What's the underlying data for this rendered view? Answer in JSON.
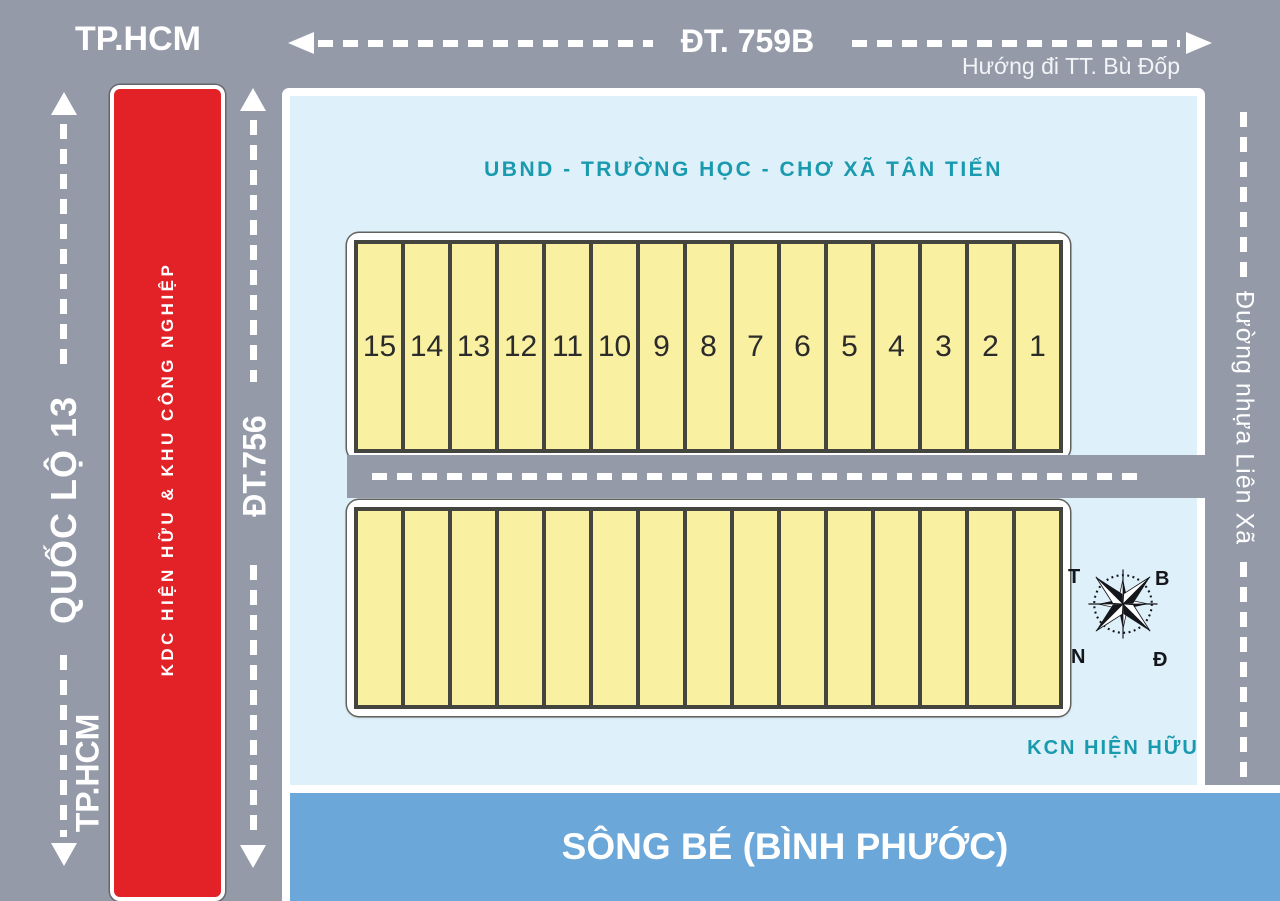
{
  "colors": {
    "road_gray": "#949aa8",
    "panel_blue": "#def0f9",
    "teal": "#1a9aae",
    "plot_yellow": "#f9f1a1",
    "plot_border": "#45453f",
    "red_strip": "#e32227",
    "river_blue": "#6ba7d8"
  },
  "top_road": {
    "name": "ĐT. 759B",
    "left_destination": "TP.HCM",
    "right_direction": "Hướng đi TT. Bù Đốp"
  },
  "left_road": {
    "name": "QUỐC LỘ 13",
    "bottom_destination": "TP.HCM"
  },
  "red_strip": {
    "label": "KDC HIỆN HỮU & KHU CÔNG NGHIỆP"
  },
  "middle_left_road": {
    "name": "ĐT.756"
  },
  "right_road": {
    "name": "Đường nhựa Liên Xã"
  },
  "panel": {
    "heading": "UBND - TRƯỜNG HỌC - CHƠ XÃ TÂN TIẾN",
    "kcn_label": "KCN HIỆN HỮU",
    "top_row_plots": [
      "15",
      "14",
      "13",
      "12",
      "11",
      "10",
      "9",
      "8",
      "7",
      "6",
      "5",
      "4",
      "3",
      "2",
      "1"
    ],
    "bottom_row_plots": [
      "",
      "",
      "",
      "",
      "",
      "",
      "",
      "",
      "",
      "",
      "",
      "",
      "",
      "",
      ""
    ]
  },
  "compass": {
    "west": "T",
    "north": "B",
    "south": "N",
    "east": "Đ"
  },
  "river": {
    "name": "SÔNG BÉ (BÌNH PHƯỚC)"
  }
}
